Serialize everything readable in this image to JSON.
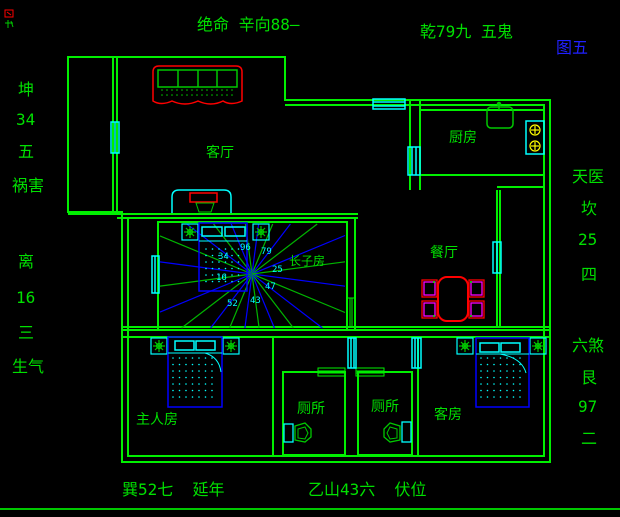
{
  "figure_label": "图五",
  "annotations": {
    "top": "绝命 辛向88—",
    "top_right": "乾79九 五鬼",
    "left": [
      "坤",
      "34",
      "五",
      "祸害",
      "离",
      "16",
      "三",
      "生气"
    ],
    "right": [
      "天医",
      "坎",
      "25",
      "四",
      "六煞",
      "艮",
      "97",
      "二"
    ],
    "bottom_left": "巽52七  延年",
    "bottom_center": "乙山43六  伏位"
  },
  "rooms": {
    "living": "客厅",
    "kitchen": "厨房",
    "dining": "餐厅",
    "eldest_son": "长子房",
    "master": "主人房",
    "toilet_1": "厕所",
    "toilet_2": "厕所",
    "guest": "客房"
  },
  "compass": {
    "numbers": [
      "96",
      "79",
      "34",
      "25",
      "16",
      "47",
      "43",
      "52"
    ]
  },
  "colors": {
    "background": "#000000",
    "walls": "#00f000",
    "labels": "#00e000",
    "furniture_cyan": "#00ffff",
    "bed_blue": "#0000ff",
    "accent_red": "#ff0000",
    "chair_magenta": "#ff00ff",
    "burner_yellow": "#ffff00",
    "figure_blue": "#2020ff",
    "ray_blue": "#0000ff",
    "ray_green": "#00b400"
  }
}
